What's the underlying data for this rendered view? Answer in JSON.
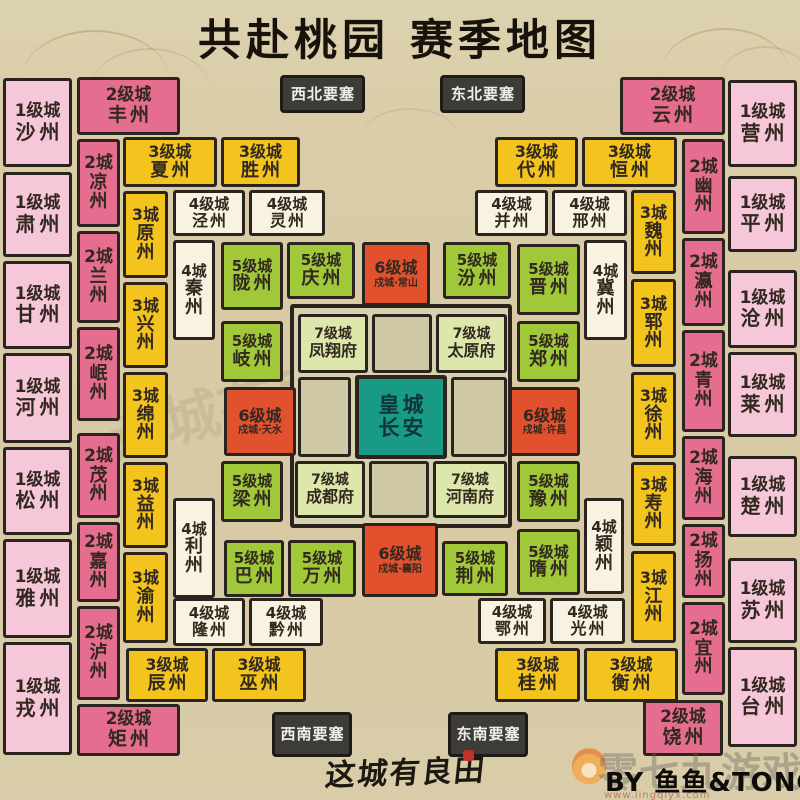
{
  "title": "共赴桃园 赛季地图",
  "footer": {
    "logo": "这城有良田",
    "credit": "BY 鱼鱼&TONG",
    "watermark_text": "零七九游戏",
    "watermark_url": "www.lingqiyx.com"
  },
  "center_watermark": "这城有良田",
  "palette": {
    "background": "#d9cca7",
    "border": "#2b231d",
    "level1_pink": "#f5c7d9",
    "level2_rose": "#e56e90",
    "level3_yellow": "#f2c41d",
    "level4_cream": "#f8f3e0",
    "level5_green": "#a0c838",
    "level6_orange": "#e2512e",
    "level7_lightgreen": "#dde7ab",
    "imperial_teal": "#189a84",
    "fortress_gray": "#3d3c38"
  },
  "map": {
    "cells": [
      {
        "t": "inner",
        "x": 290,
        "y": 304,
        "w": 222,
        "h": 224
      },
      {
        "t": "empty",
        "x": 372,
        "y": 314,
        "w": 60,
        "h": 59
      },
      {
        "t": "empty",
        "x": 298,
        "y": 377,
        "w": 53,
        "h": 80
      },
      {
        "t": "empty",
        "x": 451,
        "y": 377,
        "w": 56,
        "h": 80
      },
      {
        "t": "empty",
        "x": 369,
        "y": 461,
        "w": 60,
        "h": 57
      },
      {
        "t": "l7",
        "b": "7级城",
        "n": "凤翔府",
        "x": 298,
        "y": 314,
        "w": 70,
        "h": 59
      },
      {
        "t": "l7",
        "b": "7级城",
        "n": "太原府",
        "x": 436,
        "y": 314,
        "w": 71,
        "h": 59
      },
      {
        "t": "l7",
        "b": "7级城",
        "n": "成都府",
        "x": 295,
        "y": 461,
        "w": 70,
        "h": 57
      },
      {
        "t": "l7",
        "b": "7级城",
        "n": "河南府",
        "x": 433,
        "y": 461,
        "w": 74,
        "h": 57
      },
      {
        "t": "imp",
        "b": "皇城",
        "n": "长安",
        "x": 355,
        "y": 375,
        "w": 92,
        "h": 84
      },
      {
        "t": "l6",
        "b": "6级城",
        "s": "戍城·常山",
        "x": 362,
        "y": 242,
        "w": 68,
        "h": 64
      },
      {
        "t": "l6",
        "b": "6级城",
        "s": "戍城·天水",
        "x": 224,
        "y": 387,
        "w": 72,
        "h": 69
      },
      {
        "t": "l6",
        "b": "6级城",
        "s": "戍城·许昌",
        "x": 509,
        "y": 387,
        "w": 71,
        "h": 69
      },
      {
        "t": "l6",
        "b": "6级城",
        "s": "戍城·襄阳",
        "x": 362,
        "y": 523,
        "w": 76,
        "h": 74
      },
      {
        "t": "l5",
        "b": "5级城",
        "n": "陇州",
        "x": 221,
        "y": 242,
        "w": 62,
        "h": 68
      },
      {
        "t": "l5",
        "b": "5级城",
        "n": "庆州",
        "x": 287,
        "y": 242,
        "w": 68,
        "h": 57
      },
      {
        "t": "l5",
        "b": "5级城",
        "n": "汾州",
        "x": 443,
        "y": 242,
        "w": 68,
        "h": 57
      },
      {
        "t": "l5",
        "b": "5级城",
        "n": "晋州",
        "x": 517,
        "y": 244,
        "w": 63,
        "h": 71
      },
      {
        "t": "l5",
        "b": "5级城",
        "n": "岐州",
        "x": 221,
        "y": 321,
        "w": 62,
        "h": 61
      },
      {
        "t": "l5",
        "b": "5级城",
        "n": "郑州",
        "x": 517,
        "y": 321,
        "w": 63,
        "h": 61
      },
      {
        "t": "l5",
        "b": "5级城",
        "n": "梁州",
        "x": 221,
        "y": 461,
        "w": 62,
        "h": 61
      },
      {
        "t": "l5",
        "b": "5级城",
        "n": "豫州",
        "x": 517,
        "y": 461,
        "w": 63,
        "h": 61
      },
      {
        "t": "l5",
        "b": "5级城",
        "n": "巴州",
        "x": 224,
        "y": 540,
        "w": 60,
        "h": 57
      },
      {
        "t": "l5",
        "b": "5级城",
        "n": "万州",
        "x": 288,
        "y": 540,
        "w": 68,
        "h": 57
      },
      {
        "t": "l5",
        "b": "5级城",
        "n": "荆州",
        "x": 442,
        "y": 541,
        "w": 66,
        "h": 55
      },
      {
        "t": "l5",
        "b": "5级城",
        "n": "隋州",
        "x": 517,
        "y": 529,
        "w": 63,
        "h": 66
      },
      {
        "t": "l4",
        "b": "4级城",
        "n": "泾州",
        "x": 173,
        "y": 190,
        "w": 72,
        "h": 46
      },
      {
        "t": "l4",
        "b": "4级城",
        "n": "灵州",
        "x": 249,
        "y": 190,
        "w": 76,
        "h": 46
      },
      {
        "t": "l4",
        "b": "4级城",
        "n": "并州",
        "x": 475,
        "y": 190,
        "w": 73,
        "h": 46
      },
      {
        "t": "l4",
        "b": "4级城",
        "n": "邢州",
        "x": 552,
        "y": 190,
        "w": 75,
        "h": 46
      },
      {
        "t": "l4",
        "b": "4级城",
        "n": "隆州",
        "x": 173,
        "y": 598,
        "w": 72,
        "h": 48
      },
      {
        "t": "l4",
        "b": "4级城",
        "n": "黔州",
        "x": 249,
        "y": 598,
        "w": 74,
        "h": 48
      },
      {
        "t": "l4",
        "b": "4级城",
        "n": "鄂州",
        "x": 478,
        "y": 598,
        "w": 68,
        "h": 46
      },
      {
        "t": "l4",
        "b": "4级城",
        "n": "光州",
        "x": 550,
        "y": 598,
        "w": 75,
        "h": 46
      },
      {
        "t": "l4",
        "v": true,
        "b": "4城",
        "n": "秦州",
        "x": 173,
        "y": 240,
        "w": 42,
        "h": 100
      },
      {
        "t": "l4",
        "v": true,
        "b": "4城",
        "n": "冀州",
        "x": 584,
        "y": 240,
        "w": 43,
        "h": 100
      },
      {
        "t": "l4",
        "v": true,
        "b": "4城",
        "n": "利州",
        "x": 173,
        "y": 498,
        "w": 42,
        "h": 100
      },
      {
        "t": "l4",
        "v": true,
        "b": "4城",
        "n": "颖州",
        "x": 584,
        "y": 498,
        "w": 40,
        "h": 96
      },
      {
        "t": "l3",
        "b": "3级城",
        "n": "夏州",
        "x": 123,
        "y": 137,
        "w": 94,
        "h": 50
      },
      {
        "t": "l3",
        "b": "3级城",
        "n": "胜州",
        "x": 221,
        "y": 137,
        "w": 79,
        "h": 50
      },
      {
        "t": "l3",
        "b": "3级城",
        "n": "代州",
        "x": 495,
        "y": 137,
        "w": 83,
        "h": 50
      },
      {
        "t": "l3",
        "b": "3级城",
        "n": "恒州",
        "x": 582,
        "y": 137,
        "w": 95,
        "h": 50
      },
      {
        "t": "l3",
        "b": "3级城",
        "n": "辰州",
        "x": 126,
        "y": 648,
        "w": 82,
        "h": 54
      },
      {
        "t": "l3",
        "b": "3级城",
        "n": "巫州",
        "x": 212,
        "y": 648,
        "w": 94,
        "h": 54
      },
      {
        "t": "l3",
        "b": "3级城",
        "n": "桂州",
        "x": 495,
        "y": 648,
        "w": 85,
        "h": 54
      },
      {
        "t": "l3",
        "b": "3级城",
        "n": "衡州",
        "x": 584,
        "y": 648,
        "w": 94,
        "h": 54
      },
      {
        "t": "l3",
        "v": true,
        "b": "3城",
        "n": "原州",
        "x": 123,
        "y": 191,
        "w": 45,
        "h": 87
      },
      {
        "t": "l3",
        "v": true,
        "b": "3城",
        "n": "兴州",
        "x": 123,
        "y": 282,
        "w": 45,
        "h": 86
      },
      {
        "t": "l3",
        "v": true,
        "b": "3城",
        "n": "绵州",
        "x": 123,
        "y": 372,
        "w": 45,
        "h": 86
      },
      {
        "t": "l3",
        "v": true,
        "b": "3城",
        "n": "益州",
        "x": 123,
        "y": 462,
        "w": 45,
        "h": 86
      },
      {
        "t": "l3",
        "v": true,
        "b": "3城",
        "n": "渝州",
        "x": 123,
        "y": 552,
        "w": 45,
        "h": 91
      },
      {
        "t": "l3",
        "v": true,
        "b": "3城",
        "n": "魏州",
        "x": 631,
        "y": 190,
        "w": 45,
        "h": 84
      },
      {
        "t": "l3",
        "v": true,
        "b": "3城",
        "n": "郓州",
        "x": 631,
        "y": 279,
        "w": 45,
        "h": 88
      },
      {
        "t": "l3",
        "v": true,
        "b": "3城",
        "n": "徐州",
        "x": 631,
        "y": 372,
        "w": 45,
        "h": 86
      },
      {
        "t": "l3",
        "v": true,
        "b": "3城",
        "n": "寿州",
        "x": 631,
        "y": 462,
        "w": 45,
        "h": 84
      },
      {
        "t": "l3",
        "v": true,
        "b": "3城",
        "n": "江州",
        "x": 631,
        "y": 551,
        "w": 45,
        "h": 92
      },
      {
        "t": "l2",
        "b": "2级城",
        "n": "丰州",
        "x": 77,
        "y": 77,
        "w": 103,
        "h": 58
      },
      {
        "t": "l2",
        "b": "2级城",
        "n": "云州",
        "x": 620,
        "y": 77,
        "w": 105,
        "h": 58
      },
      {
        "t": "l2",
        "b": "2级城",
        "n": "矩州",
        "x": 77,
        "y": 704,
        "w": 103,
        "h": 52
      },
      {
        "t": "l2",
        "b": "2级城",
        "n": "饶州",
        "x": 643,
        "y": 700,
        "w": 80,
        "h": 56
      },
      {
        "t": "l2",
        "v": true,
        "b": "2城",
        "n": "凉州",
        "x": 77,
        "y": 139,
        "w": 43,
        "h": 88
      },
      {
        "t": "l2",
        "v": true,
        "b": "2城",
        "n": "兰州",
        "x": 77,
        "y": 231,
        "w": 43,
        "h": 92
      },
      {
        "t": "l2",
        "v": true,
        "b": "2城",
        "n": "岷州",
        "x": 77,
        "y": 327,
        "w": 43,
        "h": 94
      },
      {
        "t": "l2",
        "v": true,
        "b": "2城",
        "n": "茂州",
        "x": 77,
        "y": 433,
        "w": 43,
        "h": 85
      },
      {
        "t": "l2",
        "v": true,
        "b": "2城",
        "n": "嘉州",
        "x": 77,
        "y": 522,
        "w": 43,
        "h": 80
      },
      {
        "t": "l2",
        "v": true,
        "b": "2城",
        "n": "泸州",
        "x": 77,
        "y": 606,
        "w": 43,
        "h": 94
      },
      {
        "t": "l2",
        "v": true,
        "b": "2城",
        "n": "幽州",
        "x": 682,
        "y": 139,
        "w": 43,
        "h": 95
      },
      {
        "t": "l2",
        "v": true,
        "b": "2城",
        "n": "瀛州",
        "x": 682,
        "y": 238,
        "w": 43,
        "h": 88
      },
      {
        "t": "l2",
        "v": true,
        "b": "2城",
        "n": "青州",
        "x": 682,
        "y": 330,
        "w": 43,
        "h": 102
      },
      {
        "t": "l2",
        "v": true,
        "b": "2城",
        "n": "海州",
        "x": 682,
        "y": 436,
        "w": 43,
        "h": 84
      },
      {
        "t": "l2",
        "v": true,
        "b": "2城",
        "n": "扬州",
        "x": 682,
        "y": 524,
        "w": 43,
        "h": 74
      },
      {
        "t": "l2",
        "v": true,
        "b": "2城",
        "n": "宜州",
        "x": 682,
        "y": 602,
        "w": 43,
        "h": 93
      },
      {
        "t": "l1",
        "b": "1级城",
        "n": "沙州",
        "x": 3,
        "y": 78,
        "w": 69,
        "h": 89
      },
      {
        "t": "l1",
        "b": "1级城",
        "n": "肃州",
        "x": 3,
        "y": 172,
        "w": 69,
        "h": 85
      },
      {
        "t": "l1",
        "b": "1级城",
        "n": "甘州",
        "x": 3,
        "y": 261,
        "w": 69,
        "h": 88
      },
      {
        "t": "l1",
        "b": "1级城",
        "n": "河州",
        "x": 3,
        "y": 353,
        "w": 69,
        "h": 90
      },
      {
        "t": "l1",
        "b": "1级城",
        "n": "松州",
        "x": 3,
        "y": 447,
        "w": 69,
        "h": 88
      },
      {
        "t": "l1",
        "b": "1级城",
        "n": "雅州",
        "x": 3,
        "y": 539,
        "w": 69,
        "h": 99
      },
      {
        "t": "l1",
        "b": "1级城",
        "n": "戎州",
        "x": 3,
        "y": 642,
        "w": 69,
        "h": 113
      },
      {
        "t": "l1",
        "b": "1级城",
        "n": "营州",
        "x": 728,
        "y": 80,
        "w": 69,
        "h": 87
      },
      {
        "t": "l1",
        "b": "1级城",
        "n": "平州",
        "x": 728,
        "y": 176,
        "w": 69,
        "h": 76
      },
      {
        "t": "l1",
        "b": "1级城",
        "n": "沧州",
        "x": 728,
        "y": 270,
        "w": 69,
        "h": 78
      },
      {
        "t": "l1",
        "b": "1级城",
        "n": "莱州",
        "x": 728,
        "y": 352,
        "w": 69,
        "h": 85
      },
      {
        "t": "l1",
        "b": "1级城",
        "n": "楚州",
        "x": 728,
        "y": 456,
        "w": 69,
        "h": 81
      },
      {
        "t": "l1",
        "b": "1级城",
        "n": "苏州",
        "x": 728,
        "y": 558,
        "w": 69,
        "h": 85
      },
      {
        "t": "l1",
        "b": "1级城",
        "n": "台州",
        "x": 728,
        "y": 647,
        "w": 69,
        "h": 100
      },
      {
        "t": "fort",
        "n": "西北要塞",
        "x": 280,
        "y": 75,
        "w": 85,
        "h": 38
      },
      {
        "t": "fort",
        "n": "东北要塞",
        "x": 440,
        "y": 75,
        "w": 85,
        "h": 38
      },
      {
        "t": "fort",
        "n": "西南要塞",
        "x": 272,
        "y": 712,
        "w": 80,
        "h": 45
      },
      {
        "t": "fort",
        "n": "东南要塞",
        "x": 448,
        "y": 712,
        "w": 80,
        "h": 45
      }
    ]
  }
}
